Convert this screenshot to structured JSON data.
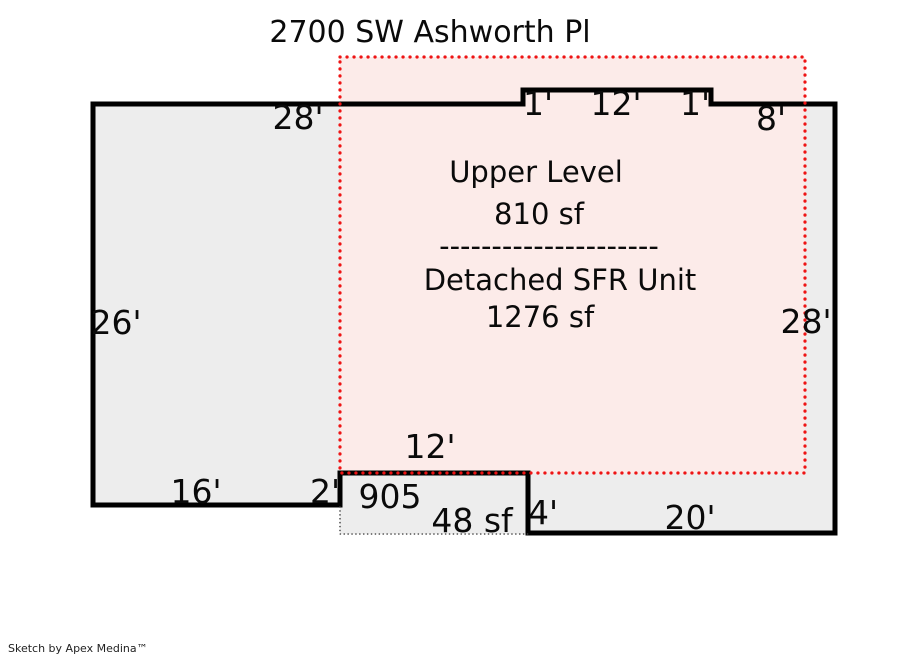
{
  "page": {
    "title": "2700 SW Ashworth Pl",
    "credit": "Sketch by Apex Medina™"
  },
  "areas": {
    "upper_level": {
      "name": "Upper Level",
      "area": "810 sf"
    },
    "divider": "---------------------",
    "detached_sfr": {
      "name": "Detached SFR Unit",
      "area": "1276 sf"
    },
    "storage": {
      "unit": "905",
      "area": "48 sf"
    }
  },
  "dimensions": {
    "top_left": "28'",
    "notch_left": "1'",
    "notch_top": "12'",
    "notch_right": "1'",
    "top_right": "8'",
    "left_side": "26'",
    "right_side": "28'",
    "storage_top": "12'",
    "bottom_left": "16'",
    "bottom_step": "2'",
    "storage_right": "4'",
    "bottom_right": "20'"
  },
  "colors": {
    "outline": "#000000",
    "footprint_fill": "#ededed",
    "upper_level_fill": "#fcebe9",
    "upper_level_border": "#ee1414",
    "storage_border": "#444444",
    "text": "#0a0a0a",
    "credit_text": "#222222"
  }
}
